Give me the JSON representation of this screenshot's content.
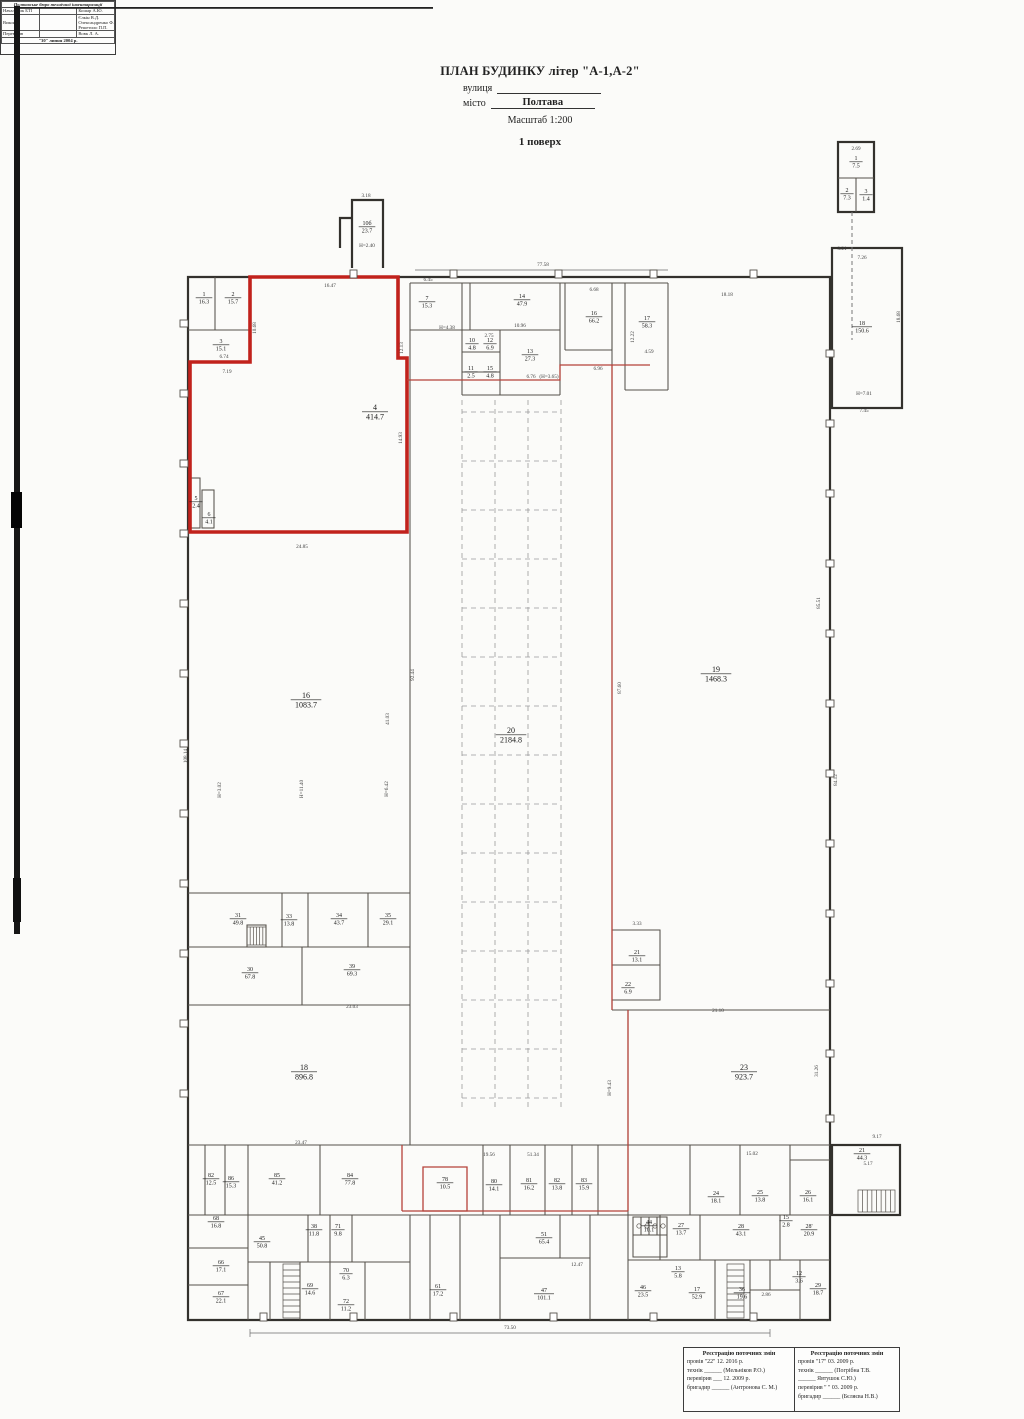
{
  "title": {
    "main": "ПЛАН БУДИНКУ літер \"А-1,А-2\"",
    "street_label": "вулиця",
    "city_label": "місто",
    "city_value": "Полтава",
    "scale": "Масштаб 1:200",
    "floor": "1 поверх"
  },
  "plan": {
    "rooms": [
      {
        "n": "1",
        "a": "16.3",
        "x": 204,
        "y": 296
      },
      {
        "n": "2",
        "a": "15.7",
        "x": 233,
        "y": 296
      },
      {
        "n": "3",
        "a": "15.1",
        "x": 221,
        "y": 343
      },
      {
        "n": "4",
        "a": "414.7",
        "x": 375,
        "y": 410,
        "b": 1
      },
      {
        "n": "5",
        "a": "2.4",
        "x": 196,
        "y": 500
      },
      {
        "n": "6",
        "a": "4.1",
        "x": 209,
        "y": 516
      },
      {
        "n": "10б",
        "a": "23.7",
        "x": 367,
        "y": 225
      },
      {
        "n": "7",
        "a": "15.3",
        "x": 427,
        "y": 300
      },
      {
        "n": "14",
        "a": "47.9",
        "x": 522,
        "y": 298
      },
      {
        "n": "16",
        "a": "66.2",
        "x": 594,
        "y": 315
      },
      {
        "n": "17",
        "a": "58.3",
        "x": 647,
        "y": 320
      },
      {
        "n": "10",
        "a": "4.8",
        "x": 472,
        "y": 342
      },
      {
        "n": "12",
        "a": "6.9",
        "x": 490,
        "y": 342
      },
      {
        "n": "13",
        "a": "27.3",
        "x": 530,
        "y": 353
      },
      {
        "n": "11",
        "a": "2.5",
        "x": 471,
        "y": 370
      },
      {
        "n": "15",
        "a": "4.8",
        "x": 490,
        "y": 370
      },
      {
        "n": "1",
        "a": "7.5",
        "x": 856,
        "y": 160
      },
      {
        "n": "2",
        "a": "7.3",
        "x": 847,
        "y": 192
      },
      {
        "n": "3",
        "a": "1.4",
        "x": 866,
        "y": 193
      },
      {
        "n": "18",
        "a": "150.6",
        "x": 862,
        "y": 325
      },
      {
        "n": "19",
        "a": "1468.3",
        "x": 716,
        "y": 672,
        "b": 1
      },
      {
        "n": "20",
        "a": "2184.8",
        "x": 511,
        "y": 733,
        "b": 1
      },
      {
        "n": "16",
        "a": "1083.7",
        "x": 306,
        "y": 698,
        "b": 1
      },
      {
        "n": "21",
        "a": "13.1",
        "x": 637,
        "y": 954
      },
      {
        "n": "22",
        "a": "6.9",
        "x": 628,
        "y": 986
      },
      {
        "n": "23",
        "a": "923.7",
        "x": 744,
        "y": 1070,
        "b": 1
      },
      {
        "n": "18",
        "a": "896.8",
        "x": 304,
        "y": 1070,
        "b": 1
      },
      {
        "n": "31",
        "a": "49.8",
        "x": 238,
        "y": 917
      },
      {
        "n": "33",
        "a": "13.8",
        "x": 289,
        "y": 918
      },
      {
        "n": "34",
        "a": "43.7",
        "x": 339,
        "y": 917
      },
      {
        "n": "35",
        "a": "29.1",
        "x": 388,
        "y": 917
      },
      {
        "n": "30",
        "a": "67.8",
        "x": 250,
        "y": 971
      },
      {
        "n": "39",
        "a": "69.3",
        "x": 352,
        "y": 968
      },
      {
        "n": "21",
        "a": "44.3",
        "x": 862,
        "y": 1152
      },
      {
        "n": "82",
        "a": "12.5",
        "x": 211,
        "y": 1177
      },
      {
        "n": "86",
        "a": "15.3",
        "x": 231,
        "y": 1180
      },
      {
        "n": "85",
        "a": "41.2",
        "x": 277,
        "y": 1177
      },
      {
        "n": "84",
        "a": "77.8",
        "x": 350,
        "y": 1177
      },
      {
        "n": "78",
        "a": "10.5",
        "x": 445,
        "y": 1181
      },
      {
        "n": "80",
        "a": "14.1",
        "x": 494,
        "y": 1183
      },
      {
        "n": "81",
        "a": "16.2",
        "x": 529,
        "y": 1182
      },
      {
        "n": "82",
        "a": "13.8",
        "x": 557,
        "y": 1182
      },
      {
        "n": "83",
        "a": "15.9",
        "x": 584,
        "y": 1182
      },
      {
        "n": "24",
        "a": "18.1",
        "x": 716,
        "y": 1195
      },
      {
        "n": "25",
        "a": "13.8",
        "x": 760,
        "y": 1194
      },
      {
        "n": "26",
        "a": "16.1",
        "x": 808,
        "y": 1194
      },
      {
        "n": "44",
        "a": "10.1",
        "x": 649,
        "y": 1224
      },
      {
        "n": "27",
        "a": "13.7",
        "x": 681,
        "y": 1227
      },
      {
        "n": "28",
        "a": "43.1",
        "x": 741,
        "y": 1228
      },
      {
        "n": "28'",
        "a": "20.9",
        "x": 809,
        "y": 1228
      },
      {
        "n": "68",
        "a": "16.8",
        "x": 216,
        "y": 1220
      },
      {
        "n": "45",
        "a": "50.8",
        "x": 262,
        "y": 1240
      },
      {
        "n": "38",
        "a": "11.8",
        "x": 314,
        "y": 1228
      },
      {
        "n": "71",
        "a": "9.8",
        "x": 338,
        "y": 1228
      },
      {
        "n": "66",
        "a": "17.1",
        "x": 221,
        "y": 1264
      },
      {
        "n": "67",
        "a": "22.1",
        "x": 221,
        "y": 1295
      },
      {
        "n": "69",
        "a": "14.6",
        "x": 310,
        "y": 1287
      },
      {
        "n": "70",
        "a": "6.3",
        "x": 346,
        "y": 1272
      },
      {
        "n": "72",
        "a": "11.2",
        "x": 346,
        "y": 1303
      },
      {
        "n": "61",
        "a": "17.2",
        "x": 438,
        "y": 1288
      },
      {
        "n": "51",
        "a": "65.4",
        "x": 544,
        "y": 1236
      },
      {
        "n": "47",
        "a": "101.1",
        "x": 544,
        "y": 1292
      },
      {
        "n": "46",
        "a": "23.5",
        "x": 643,
        "y": 1289
      },
      {
        "n": "17",
        "a": "52.9",
        "x": 697,
        "y": 1291
      },
      {
        "n": "36",
        "a": "19.6",
        "x": 742,
        "y": 1291
      },
      {
        "n": "29",
        "a": "18.7",
        "x": 818,
        "y": 1287
      },
      {
        "n": "13",
        "a": "5.8",
        "x": 678,
        "y": 1270
      },
      {
        "n": "15",
        "a": "2.8",
        "x": 786,
        "y": 1219
      },
      {
        "n": "12",
        "a": "3.6",
        "x": 799,
        "y": 1275
      }
    ],
    "dims": [
      {
        "t": "77.58",
        "x": 543,
        "y": 266
      },
      {
        "t": "16.47",
        "x": 330,
        "y": 287
      },
      {
        "t": "6.45",
        "x": 428,
        "y": 281
      },
      {
        "t": "18.18",
        "x": 727,
        "y": 296
      },
      {
        "t": "6.68",
        "x": 594,
        "y": 291
      },
      {
        "t": "3.18",
        "x": 366,
        "y": 197
      },
      {
        "t": "Н=2.40",
        "x": 367,
        "y": 247
      },
      {
        "t": "2.69",
        "x": 856,
        "y": 150
      },
      {
        "t": "10.68",
        "x": 256,
        "y": 328,
        "r": 1
      },
      {
        "t": "12.13",
        "x": 403,
        "y": 348,
        "r": 1
      },
      {
        "t": "6.74",
        "x": 224,
        "y": 358
      },
      {
        "t": "7.19",
        "x": 227,
        "y": 373
      },
      {
        "t": "14.93",
        "x": 402,
        "y": 438,
        "r": 1
      },
      {
        "t": "24.85",
        "x": 302,
        "y": 548
      },
      {
        "t": "12.22",
        "x": 634,
        "y": 337,
        "r": 1
      },
      {
        "t": "4.59",
        "x": 649,
        "y": 353
      },
      {
        "t": "6.96",
        "x": 598,
        "y": 370
      },
      {
        "t": "(Н=3.65)",
        "x": 549,
        "y": 378
      },
      {
        "t": "10.96",
        "x": 520,
        "y": 327
      },
      {
        "t": "2.75",
        "x": 489,
        "y": 337
      },
      {
        "t": "6.76",
        "x": 531,
        "y": 378
      },
      {
        "t": "Н=4.38",
        "x": 447,
        "y": 329
      },
      {
        "t": "3.21",
        "x": 842,
        "y": 250
      },
      {
        "t": "7.26",
        "x": 862,
        "y": 259
      },
      {
        "t": "18.68",
        "x": 900,
        "y": 317,
        "r": 1
      },
      {
        "t": "Н=7.01",
        "x": 864,
        "y": 395
      },
      {
        "t": "7.45",
        "x": 864,
        "y": 412
      },
      {
        "t": "108.14",
        "x": 187,
        "y": 756,
        "r": 1
      },
      {
        "t": "92.44",
        "x": 414,
        "y": 675,
        "r": 1
      },
      {
        "t": "41.03",
        "x": 389,
        "y": 719,
        "r": 1
      },
      {
        "t": "87.60",
        "x": 621,
        "y": 688,
        "r": 1
      },
      {
        "t": "85.51",
        "x": 820,
        "y": 603,
        "r": 1
      },
      {
        "t": "84.12",
        "x": 837,
        "y": 780,
        "r": 1
      },
      {
        "t": "Н=3.02",
        "x": 221,
        "y": 790,
        "r": 1
      },
      {
        "t": "Н=11.40",
        "x": 303,
        "y": 789,
        "r": 1
      },
      {
        "t": "Н=6.42",
        "x": 388,
        "y": 789,
        "r": 1
      },
      {
        "t": "Н=9.43",
        "x": 611,
        "y": 1088,
        "r": 1
      },
      {
        "t": "23.03",
        "x": 352,
        "y": 1008
      },
      {
        "t": "21.10",
        "x": 718,
        "y": 1012
      },
      {
        "t": "31.26",
        "x": 818,
        "y": 1071,
        "r": 1
      },
      {
        "t": "23.47",
        "x": 301,
        "y": 1144
      },
      {
        "t": "19.56",
        "x": 489,
        "y": 1156
      },
      {
        "t": "51.34",
        "x": 533,
        "y": 1156
      },
      {
        "t": "15.02",
        "x": 752,
        "y": 1155
      },
      {
        "t": "12.47",
        "x": 577,
        "y": 1266
      },
      {
        "t": "2.86",
        "x": 766,
        "y": 1296
      },
      {
        "t": "73.50",
        "x": 510,
        "y": 1329
      },
      {
        "t": "3.33",
        "x": 637,
        "y": 925
      },
      {
        "t": "9.17",
        "x": 877,
        "y": 1138
      },
      {
        "t": "5.17",
        "x": 868,
        "y": 1165
      }
    ]
  },
  "stamps": {
    "reg1": {
      "header": "Реєстрацію поточних змін",
      "l1": "провів  \"22\" 12. 2016 р.",
      "l2": "технік ______ (Мельніков Р.О.)",
      "l3": "перевірив ___ 12. 2009 р.",
      "l4": "бригадир ______ (Антронова С. М.)"
    },
    "reg2": {
      "header": "Реєстрацію поточних змін",
      "l1": "провів  \"17\" 03. 2009 р.",
      "l2": "технік ______ (Погрібна Т.В.",
      "l3": "______ Явтушок С.Ю.)",
      "l4": "перевірив \" \" 03. 2009 р.",
      "l5": "бригадир ______ (Бєляєва Н.В.)"
    },
    "bti": {
      "header": "Полтавське бюро технічної інвентаризації",
      "row1_label": "Начальник БТІ",
      "row1_name": "Кошар А.Ю.",
      "row2_label": "Виконав",
      "row2_name1": "Єлкін В.Д.",
      "row2_name2": "Олександренко Ф.А.",
      "row2_name3": "Решетило П.П.",
      "row3_label": "Перевірив",
      "row3_name": "Вовк Л. А.",
      "footer": "\"30\" липня 2004 р."
    }
  },
  "colors": {
    "red": "#c1221c",
    "red_thin": "#b5423a",
    "wall": "#33312d",
    "wall_inner": "#56524b"
  }
}
